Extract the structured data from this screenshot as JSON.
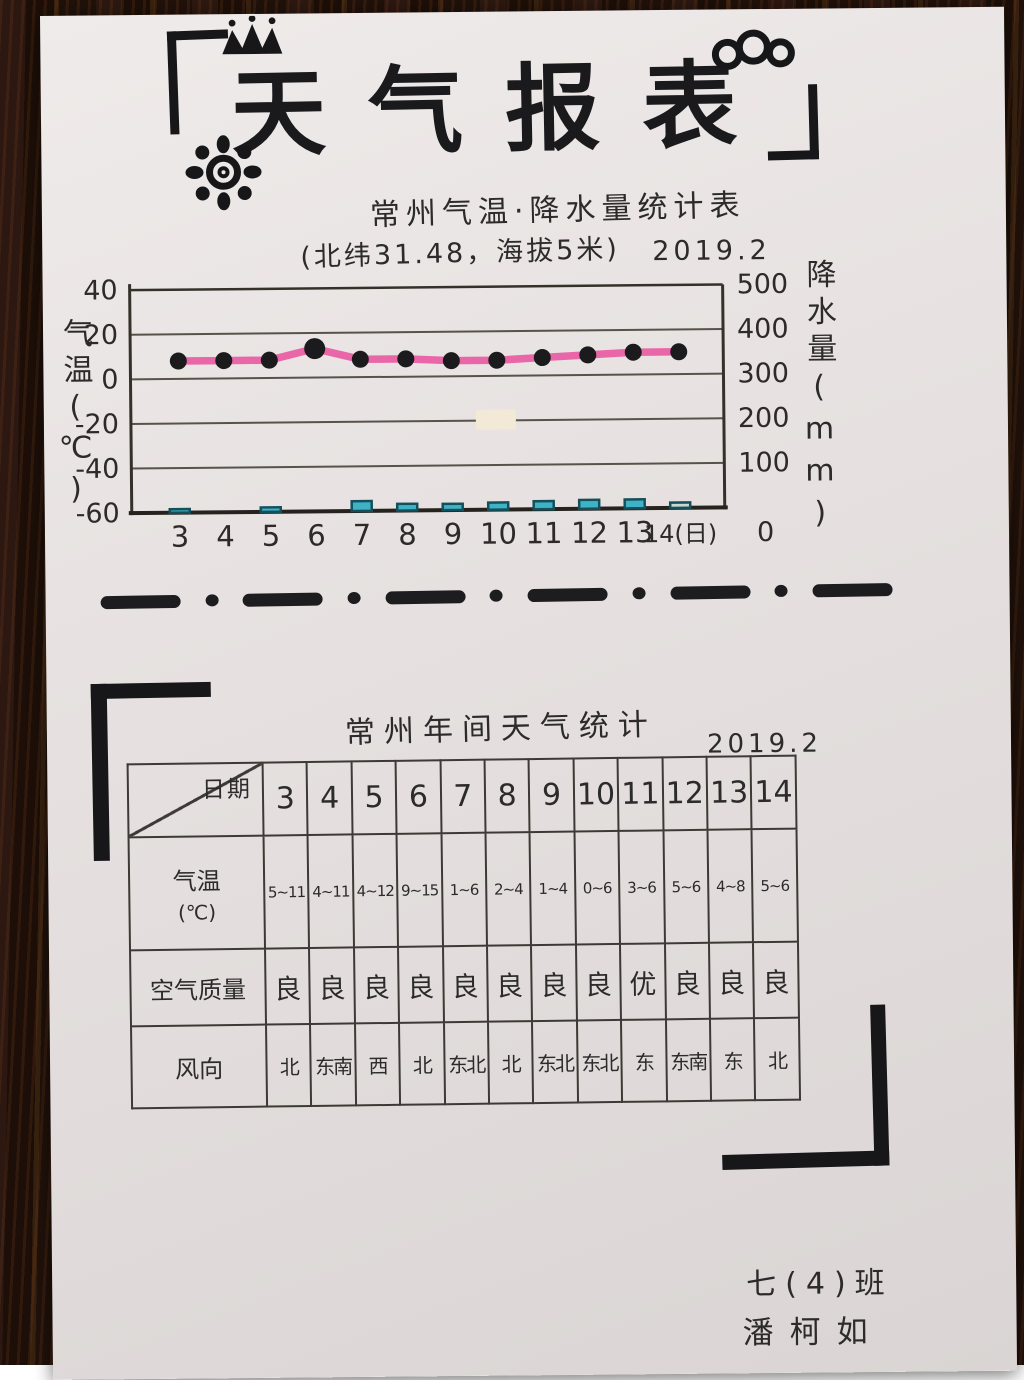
{
  "page": {
    "title": "天气报表",
    "signature": {
      "class_label": "七(4)班",
      "name": "潘柯如"
    },
    "table_section": {
      "title": "常州年间天气统计",
      "date": "2019.2",
      "corner_label": "日期",
      "days": [
        "3",
        "4",
        "5",
        "6",
        "7",
        "8",
        "9",
        "10",
        "11",
        "12",
        "13",
        "14"
      ],
      "rows": [
        {
          "label": "气温",
          "unit": "(℃)",
          "values": [
            "5~11",
            "4~11",
            "4~12",
            "9~15",
            "1~6",
            "2~4",
            "1~4",
            "0~6",
            "3~6",
            "5~6",
            "4~8",
            "5~6"
          ]
        },
        {
          "label": "空气质量",
          "values": [
            "良",
            "良",
            "良",
            "良",
            "良",
            "良",
            "良",
            "良",
            "优",
            "良",
            "良",
            "良"
          ]
        },
        {
          "label": "风向",
          "values": [
            "北",
            "东南",
            "西",
            "北",
            "东北",
            "北",
            "东北",
            "东北",
            "东",
            "东南",
            "东",
            "北"
          ]
        }
      ]
    }
  },
  "chart_data": {
    "type": "line",
    "title": "常州气温·降水量统计表",
    "subtitle": "(北纬31.48，海拔5米)",
    "date": "2019.2",
    "x_label_days": [
      "3",
      "4",
      "5",
      "6",
      "7",
      "8",
      "9",
      "10",
      "11",
      "12",
      "13",
      "14(日)"
    ],
    "left_axis": {
      "label": "气温(℃)",
      "ticks": [
        "40",
        "20",
        "0",
        "-20",
        "-40",
        "-60"
      ],
      "range": [
        -60,
        40
      ]
    },
    "right_axis": {
      "label": "降水量(mm)",
      "ticks": [
        "500",
        "400",
        "300",
        "200",
        "100",
        "0"
      ],
      "range": [
        0,
        500
      ]
    },
    "grid": true,
    "legend": "none",
    "series": [
      {
        "name": "气温(℃)",
        "type": "line",
        "color": "#e8559f",
        "point_color": "#1b1b1d",
        "values": [
          8,
          8,
          8,
          13,
          8,
          8,
          7,
          7,
          8,
          9,
          10,
          10
        ]
      },
      {
        "name": "降水量(mm)",
        "type": "bar",
        "color": "#3fb3c6",
        "values": [
          8,
          0,
          10,
          0,
          22,
          15,
          14,
          16,
          18,
          20,
          20,
          12
        ]
      }
    ]
  }
}
